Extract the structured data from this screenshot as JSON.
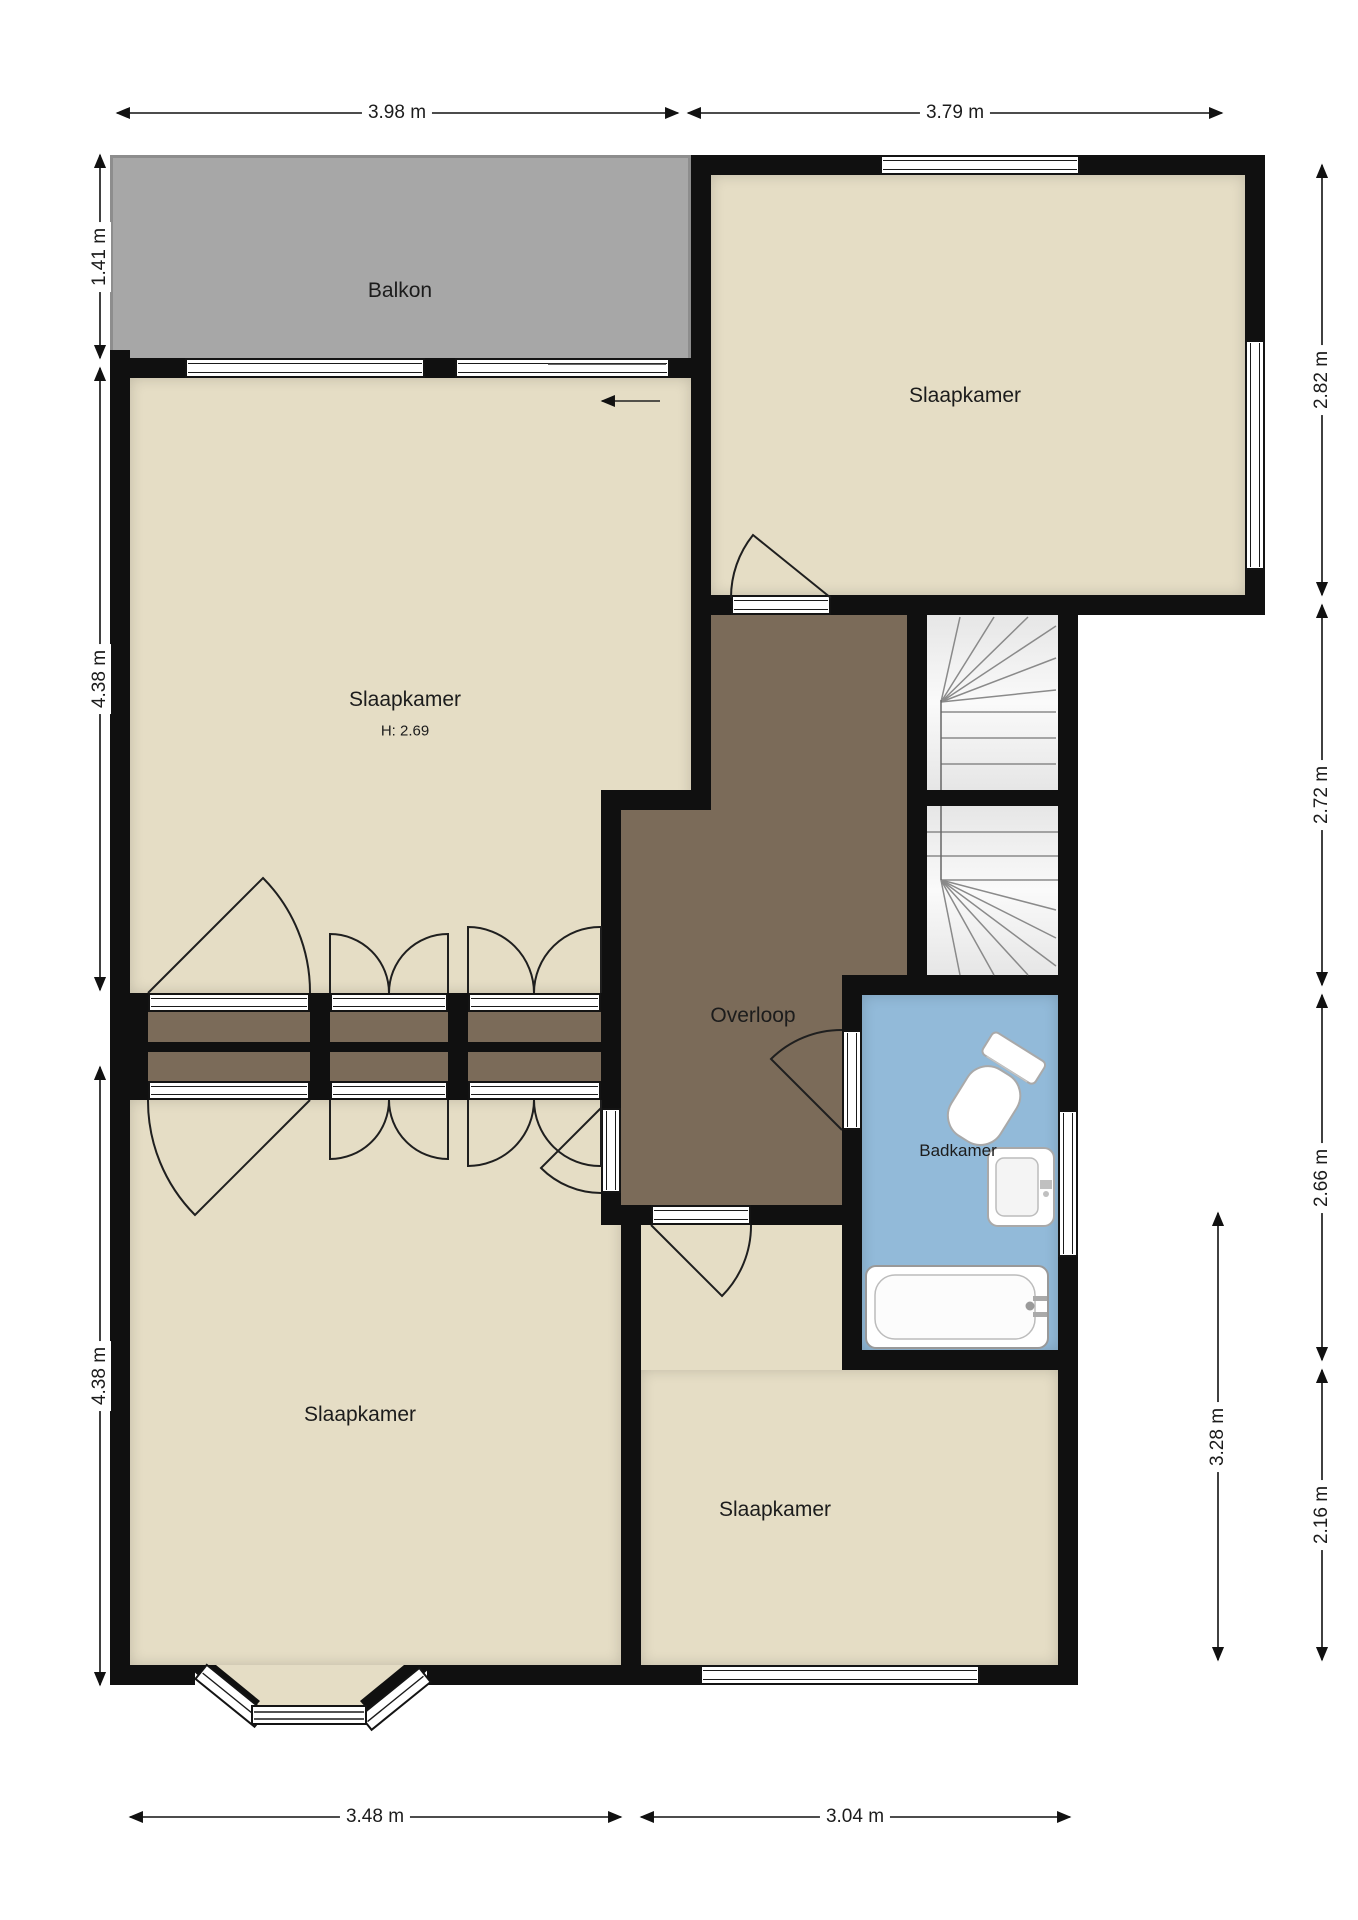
{
  "plan": {
    "type": "floorplan",
    "rooms": [
      {
        "id": "balkon",
        "label": "Balkon"
      },
      {
        "id": "slaapkamer-top-right",
        "label": "Slaapkamer"
      },
      {
        "id": "slaapkamer-upper-left",
        "label": "Slaapkamer",
        "height_note": "H: 2.69"
      },
      {
        "id": "overloop",
        "label": "Overloop"
      },
      {
        "id": "badkamer",
        "label": "Badkamer"
      },
      {
        "id": "slaapkamer-lower-left",
        "label": "Slaapkamer"
      },
      {
        "id": "slaapkamer-lower-right",
        "label": "Slaapkamer"
      }
    ],
    "dimensions": {
      "top": [
        {
          "label": "3.98 m"
        },
        {
          "label": "3.79 m"
        }
      ],
      "left": [
        {
          "label": "1.41 m"
        },
        {
          "label": "4.38 m"
        },
        {
          "label": "4.38 m"
        }
      ],
      "right": [
        {
          "label": "2.82 m"
        },
        {
          "label": "2.72 m"
        },
        {
          "label": "2.66 m"
        },
        {
          "label": "2.16 m"
        }
      ],
      "right_inner": [
        {
          "label": "3.28 m"
        }
      ],
      "bottom": [
        {
          "label": "3.48 m"
        },
        {
          "label": "3.04 m"
        }
      ]
    },
    "fixtures": [
      {
        "name": "staircase-upper-flight"
      },
      {
        "name": "staircase-lower-flight"
      },
      {
        "name": "toilet"
      },
      {
        "name": "washbasin"
      },
      {
        "name": "bathtub"
      },
      {
        "name": "sliding-door-arrow"
      }
    ],
    "colors": {
      "room-floor": "#e5ddc5",
      "hall-floor": "#7b6b59",
      "bath-floor": "#92bad9",
      "balcony": "#a7a7a7",
      "balcony-border": "#8d8d8d",
      "wall": "#101010",
      "stairs": "#f2f2f2",
      "stroke": "#1f1f1f"
    }
  }
}
